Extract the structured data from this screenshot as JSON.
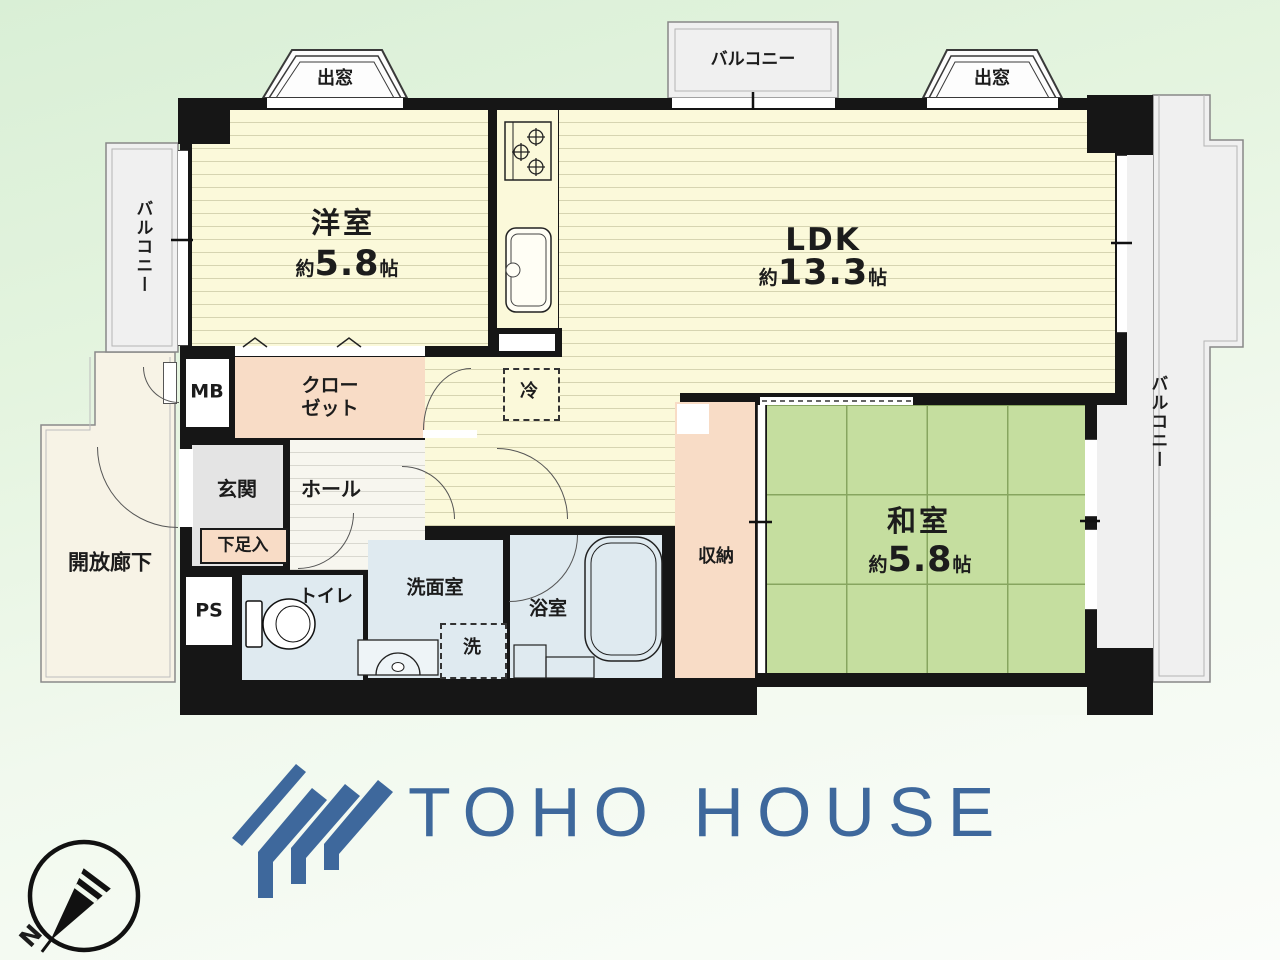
{
  "meta": {
    "type": "apartment-floor-plan"
  },
  "branding": {
    "logo_text": "TOHO HOUSE",
    "logo_color": "#3e689c"
  },
  "compass": {
    "north_label": "N"
  },
  "exterior": {
    "balcony_top": "バルコニー",
    "balcony_left": "バルコニー",
    "balcony_right": "バルコニー",
    "bay_window_left": "出窓",
    "bay_window_right": "出窓",
    "open_corridor": "開放廊下"
  },
  "rooms": {
    "western_room": {
      "name": "洋室",
      "size_prefix": "約",
      "size_value": "5.8",
      "size_unit": "帖"
    },
    "ldk": {
      "name": "LDK",
      "size_prefix": "約",
      "size_value": "13.3",
      "size_unit": "帖"
    },
    "japanese_room": {
      "name": "和室",
      "size_prefix": "約",
      "size_value": "5.8",
      "size_unit": "帖"
    },
    "hall": "ホール",
    "entrance": "玄関",
    "shoe_cabinet": "下足入",
    "closet_line1": "クロー",
    "closet_line2": "ゼット",
    "meter_box": "MB",
    "pipe_space": "PS",
    "toilet": "トイレ",
    "washroom": "洗面室",
    "washer": "洗",
    "bathroom": "浴室",
    "storage": "収納",
    "refrigerator": "冷"
  },
  "colors": {
    "wall": "#161616",
    "flooring": "#fbf9da",
    "tatami": "#c5de9f",
    "closet_salmon": "#f8dcc6",
    "wet_area_blue": "#dfeaf0",
    "entrance_gray": "#e4e4e4",
    "balcony_gray": "#f0f0f0",
    "background_green": "#e3f4de",
    "logo_blue": "#3e689c"
  }
}
